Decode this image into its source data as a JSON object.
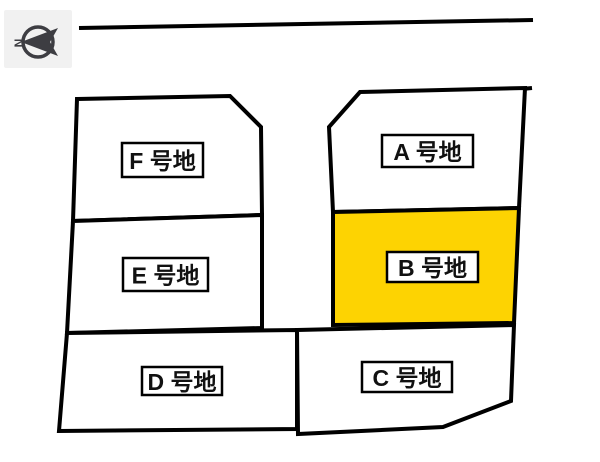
{
  "diagram": {
    "background": "#ffffff",
    "outline_color": "#000000",
    "highlight_color": "#fdd302",
    "label_box_bg": "#ffffff",
    "label_text_color": "#111111",
    "outline_width": 4,
    "label_box_border_width": 2.5
  },
  "compass": {
    "letter": "N",
    "panel_bg": "#f1f1f1",
    "icon_color": "#3d3d42",
    "panel": {
      "x": 4,
      "y": 10,
      "w": 68,
      "h": 58
    },
    "circle": {
      "cx": 38,
      "cy": 42,
      "r": 15
    },
    "needle_points": "21,42 58,28 50,42 58,56"
  },
  "roads": [
    {
      "name": "top-road-line",
      "x1": 79,
      "y1": 28,
      "x2": 533,
      "y2": 20,
      "width": 4
    },
    {
      "name": "plot-a-top-overhang-line",
      "x1": 522,
      "y1": 89,
      "x2": 532,
      "y2": 88,
      "width": 4
    }
  ],
  "plots": [
    {
      "id": "F",
      "label": "F 号地",
      "highlighted": false,
      "points": "77,99 230,96 261,127 262,215 73,221",
      "label_box": {
        "x": 122,
        "y": 143,
        "w": 81,
        "h": 34
      }
    },
    {
      "id": "E",
      "label": "E 号地",
      "highlighted": false,
      "points": "73,221 262,215 262,328 67,333",
      "label_box": {
        "x": 123,
        "y": 258,
        "w": 85,
        "h": 33
      }
    },
    {
      "id": "D",
      "label": "D 号地",
      "highlighted": false,
      "points": "67,333 297,330 297,429 59,431",
      "label_box": {
        "x": 142,
        "y": 367,
        "w": 80,
        "h": 28
      }
    },
    {
      "id": "A",
      "label": "A 号地",
      "highlighted": false,
      "points": "360,92 525,88 519,208 333,212 329,127",
      "label_box": {
        "x": 382,
        "y": 135,
        "w": 91,
        "h": 32
      }
    },
    {
      "id": "B",
      "label": "B 号地",
      "highlighted": true,
      "points": "333,212 519,208 514,323 333,325",
      "label_box": {
        "x": 387,
        "y": 252,
        "w": 91,
        "h": 30
      }
    },
    {
      "id": "C",
      "label": "C 号地",
      "highlighted": false,
      "points": "297,330 514,325 511,401 443,427 298,434",
      "label_box": {
        "x": 362,
        "y": 362,
        "w": 90,
        "h": 30
      }
    }
  ]
}
